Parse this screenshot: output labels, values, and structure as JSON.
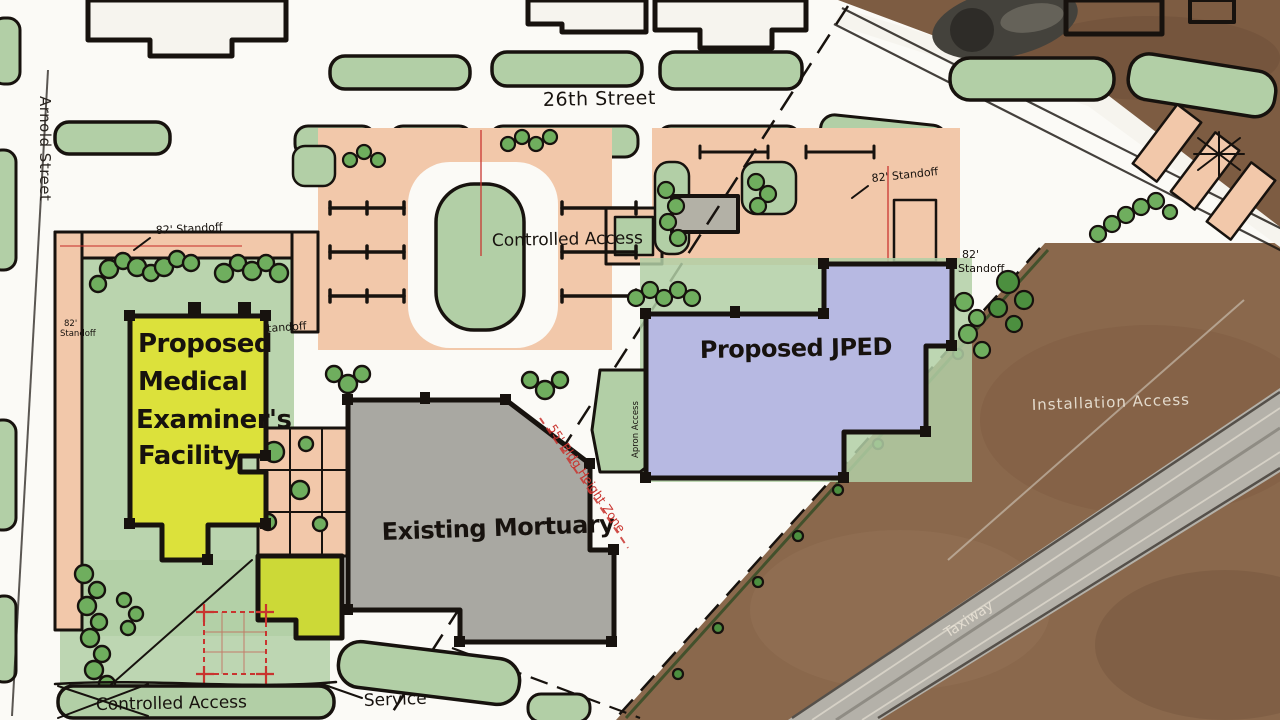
{
  "plan": {
    "streets": {
      "street_26th": "26th Street",
      "arnold": "Arnold Street"
    },
    "buildings": {
      "me_facility_lines": [
        "Proposed",
        "Medical",
        "Examiner's",
        "Facility"
      ],
      "existing_mortuary": "Existing Mortuary",
      "proposed_jped": "Proposed JPED"
    },
    "labels": {
      "controlled_access": "Controlled Access",
      "service": "Service",
      "standoff": "82' Standoff",
      "standoff_value": "82'",
      "standoff_word": "Standoff",
      "height_zone": "55' Bldg Height Zone",
      "installation_access": "Installation Access",
      "taxiway": "Taxiway",
      "apron_access": "Apron Access"
    },
    "colors": {
      "paper": "#fbfaf6",
      "field_brown": "#8a684c",
      "lawn_green": "#b2cfa6",
      "tree_green": "#6fae5e",
      "parking_peach": "#f2c8aa",
      "me_yellow": "#dce13b",
      "annex_yellow": "#ccd937",
      "mortuary_gray": "#a9a8a2",
      "jped_lavender": "#b7b9e2",
      "ink": "#17120e",
      "annotation_red": "#c9342f",
      "taxiway_gray": "#b4b1a9"
    }
  }
}
